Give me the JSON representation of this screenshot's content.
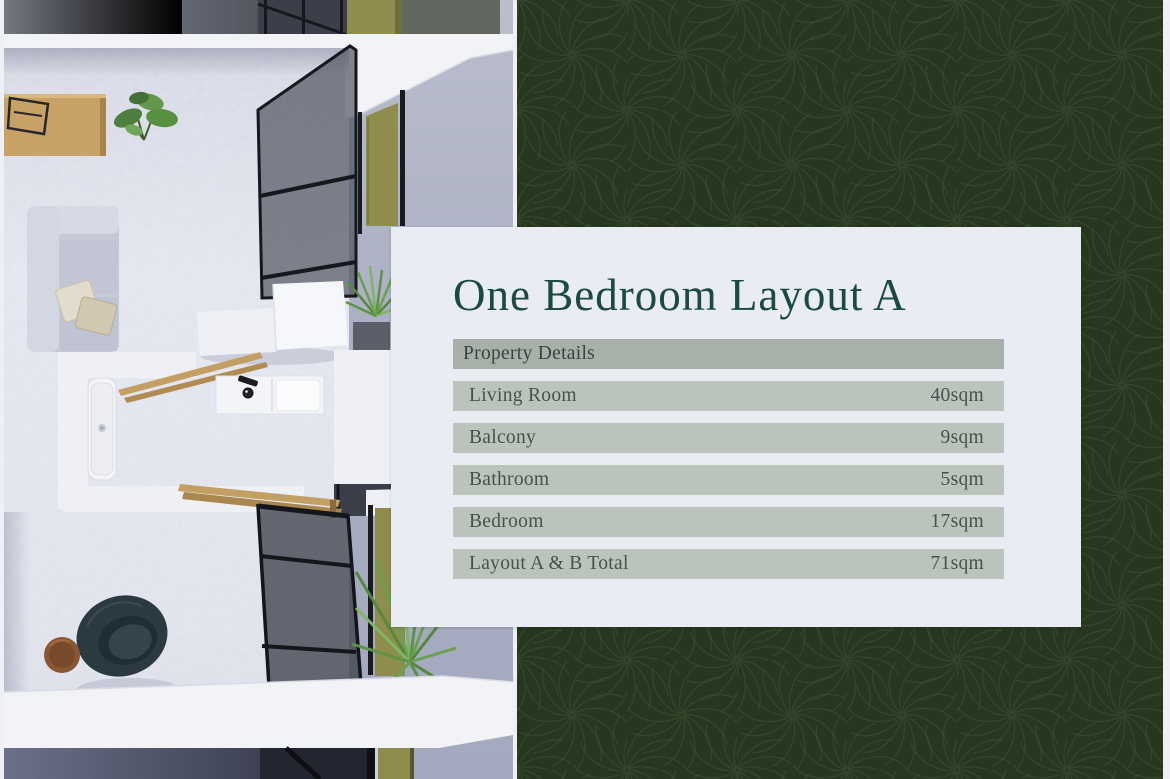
{
  "card": {
    "title": "One Bedroom Layout A",
    "table": {
      "header": "Property Details",
      "rows": [
        {
          "label": "Living Room",
          "value": "40sqm"
        },
        {
          "label": "Balcony",
          "value": "9sqm"
        },
        {
          "label": "Bathroom",
          "value": "5sqm"
        },
        {
          "label": "Bedroom",
          "value": "17sqm"
        },
        {
          "label": "Layout A & B Total",
          "value": "71sqm"
        }
      ]
    }
  },
  "floorplan": {
    "alt": "Top-down 3D render of a one-bedroom apartment with living room, bathroom, bedroom and balcony"
  },
  "background": {
    "pattern": "pinwheel-swirl",
    "color": "#27361f"
  },
  "colors": {
    "accent_green": "#1b4a41",
    "panel_green": "#27361f",
    "card_bg": "#e9ecf2",
    "header_row_bg": "#a7b1aa",
    "data_row_bg": "#bac3bc",
    "row_text": "#47524c"
  }
}
